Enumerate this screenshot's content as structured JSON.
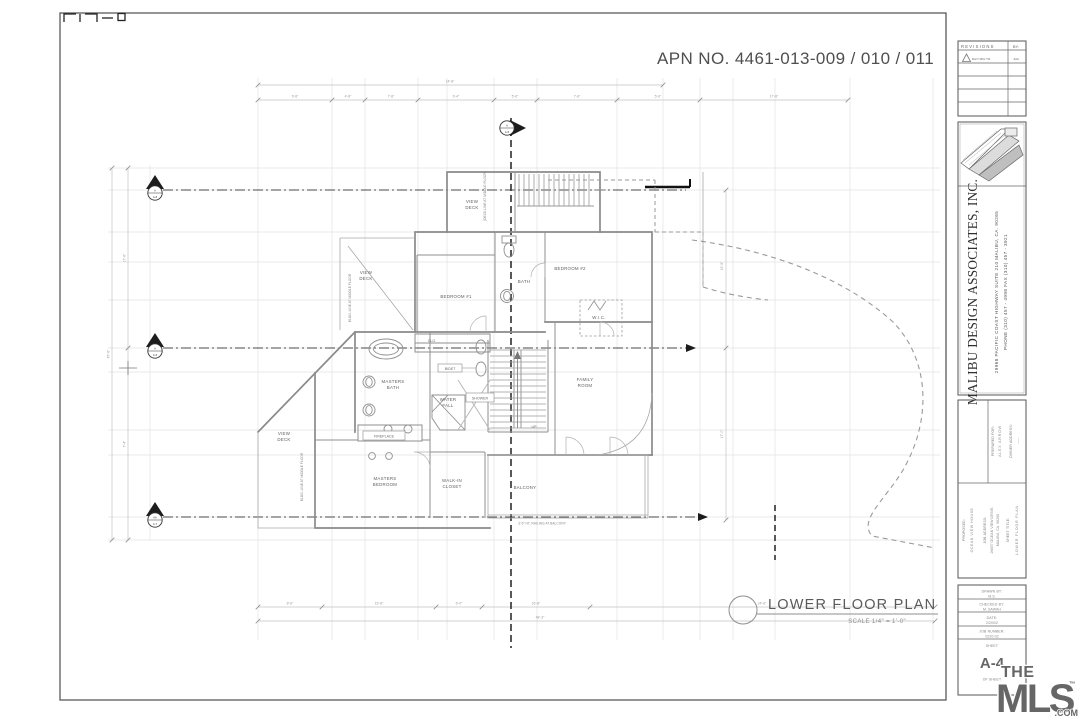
{
  "sheet": {
    "apn": "APN NO.  4461-013-009 / 010 / 011",
    "title": "LOWER FLOOR PLAN",
    "scale": "SCALE  1/4\" = 1'-0\""
  },
  "rooms": {
    "view_deck": [
      "VIEW",
      "DECK"
    ],
    "bedroom_1": "BEDROOM #1",
    "bedroom_2": "BEDROOM #2",
    "bath": "BATH",
    "wic": "W.I.C.",
    "clo": "CLO.",
    "masters_bath": [
      "MASTERS",
      "BATH"
    ],
    "water_fall": [
      "WATER",
      "FALL"
    ],
    "shower": "SHOWER",
    "bidet": "BIDET",
    "family_room": [
      "FAMILY",
      "ROOM"
    ],
    "masters_bedroom": [
      "MASTERS",
      "BEDROOM"
    ],
    "walk_in_closet": [
      "WALK-IN",
      "CLOSET"
    ],
    "balcony": "BALCONY",
    "fireplace": "FIREPLACE",
    "up": "UP"
  },
  "notes": {
    "railing": "3'-6\" HT. RAILING AT BALCONY",
    "bldg_line": "BLDG. LINE AT MIDDLE FLOOR",
    "deck_line": "(DECK LINE AT MIDDLE FLOOR)"
  },
  "dims": {
    "top_overall": "14'-8\"",
    "top": [
      "9'-8\"",
      "4'-8\"",
      "7'-8\"",
      "9'-4\"",
      "5'-6\"",
      "7'-8\"",
      "5'-6\"",
      "17'-8\""
    ],
    "bottom": [
      "8'-6\"",
      "15'-8\"",
      "6'-0\"",
      "16'-8\"",
      "24'-6\""
    ],
    "bottom_overall": "48'-3\"",
    "left_overall": "47'-6\"",
    "left": [
      "17'-6\"",
      "7'-4\""
    ],
    "right": [
      "15'-9\"",
      "17'-0\""
    ]
  },
  "markers": {
    "m1": [
      "A",
      "A-8"
    ],
    "m2": [
      "A",
      "A-6"
    ],
    "m3": [
      "AA",
      "A-7"
    ],
    "mtop": [
      "A",
      "A-5"
    ]
  },
  "revisions": {
    "title": "REVISIONS",
    "by": "BY:",
    "row1_date": "DAY/ MO/ YR",
    "row1_by": "JHA"
  },
  "firm": {
    "name": "MALIBU DESIGN ASSOCIATES, INC.",
    "address": "29968   PACIFIC   COAST   HIGHWAY   SUITE   210      MALIBU,  CA.  90265",
    "phone": "PHONE (310) 457 - 4998                FAX (310) 457 - 3921"
  },
  "project": {
    "prepared_for_label": "PREPARED FOR:",
    "prepared_for": "ALEX ARROW",
    "owner_label": "OWNER ADDRESS:",
    "owner": "-----",
    "proposed_label": "PROPOSED:",
    "proposed": "OCEAN VIEW HOUSE",
    "job_label": "JOB ADDRESS:",
    "job_address_1": "26657 OCEAN VIEW DRIVE,",
    "job_address_2": "MALIBU, CA. 90265",
    "sheet_title_label": "SHEET TITLE:",
    "sheet_title": "LOWER FLOOR PLAN"
  },
  "titleblock": {
    "drawn_label": "DRAWN  BY:",
    "drawn": "M.S.",
    "checked_label": "CHECKED  BY:",
    "checked": "M. SAWAH",
    "date_label": "DATE:",
    "date": "2/20/02",
    "job_label": "JOB NUMBER:",
    "job": "0220-02",
    "sheet_label": "SHEET",
    "sheet": "A-4",
    "of_sheet": "OF    SHEET"
  },
  "mls": {
    "the": "THE",
    "name": "MLS",
    "tm": "™",
    "com": ".COM",
    "color": "#e31e2d"
  }
}
